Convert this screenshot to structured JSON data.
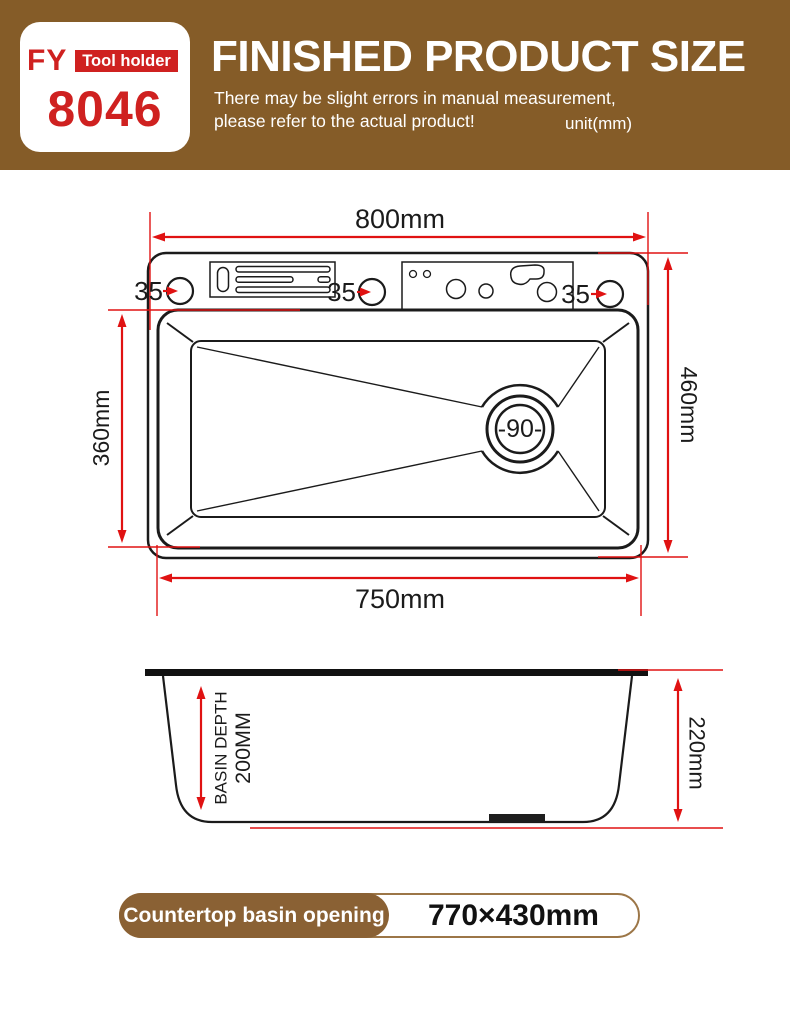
{
  "colors": {
    "header_brown": "#855C28",
    "badge_brown": "#8A6134",
    "brand_red": "#CF2120",
    "dimension_red": "#E01212",
    "line_black": "#1B1B1B"
  },
  "header": {
    "logo": {
      "brand": "FY",
      "tag": "Tool holder",
      "model": "8046"
    },
    "title": "FINISHED PRODUCT SIZE",
    "subtitle_line1": "There may be slight errors in manual measurement,",
    "subtitle_line2": "please refer to the actual product!",
    "unit": "unit(mm)"
  },
  "top_view": {
    "width_label": "800mm",
    "right_label": "460mm",
    "left_label": "360mm",
    "bottom_label": "750mm",
    "hole_labels": [
      "35",
      "35",
      "35"
    ],
    "drain_label": "-90-"
  },
  "side_view": {
    "depth_label_line1": "BASIN DEPTH",
    "depth_label_line2": "200MM",
    "height_label": "220mm"
  },
  "footer": {
    "badge_label": "Countertop basin opening",
    "badge_value": "770×430mm"
  }
}
